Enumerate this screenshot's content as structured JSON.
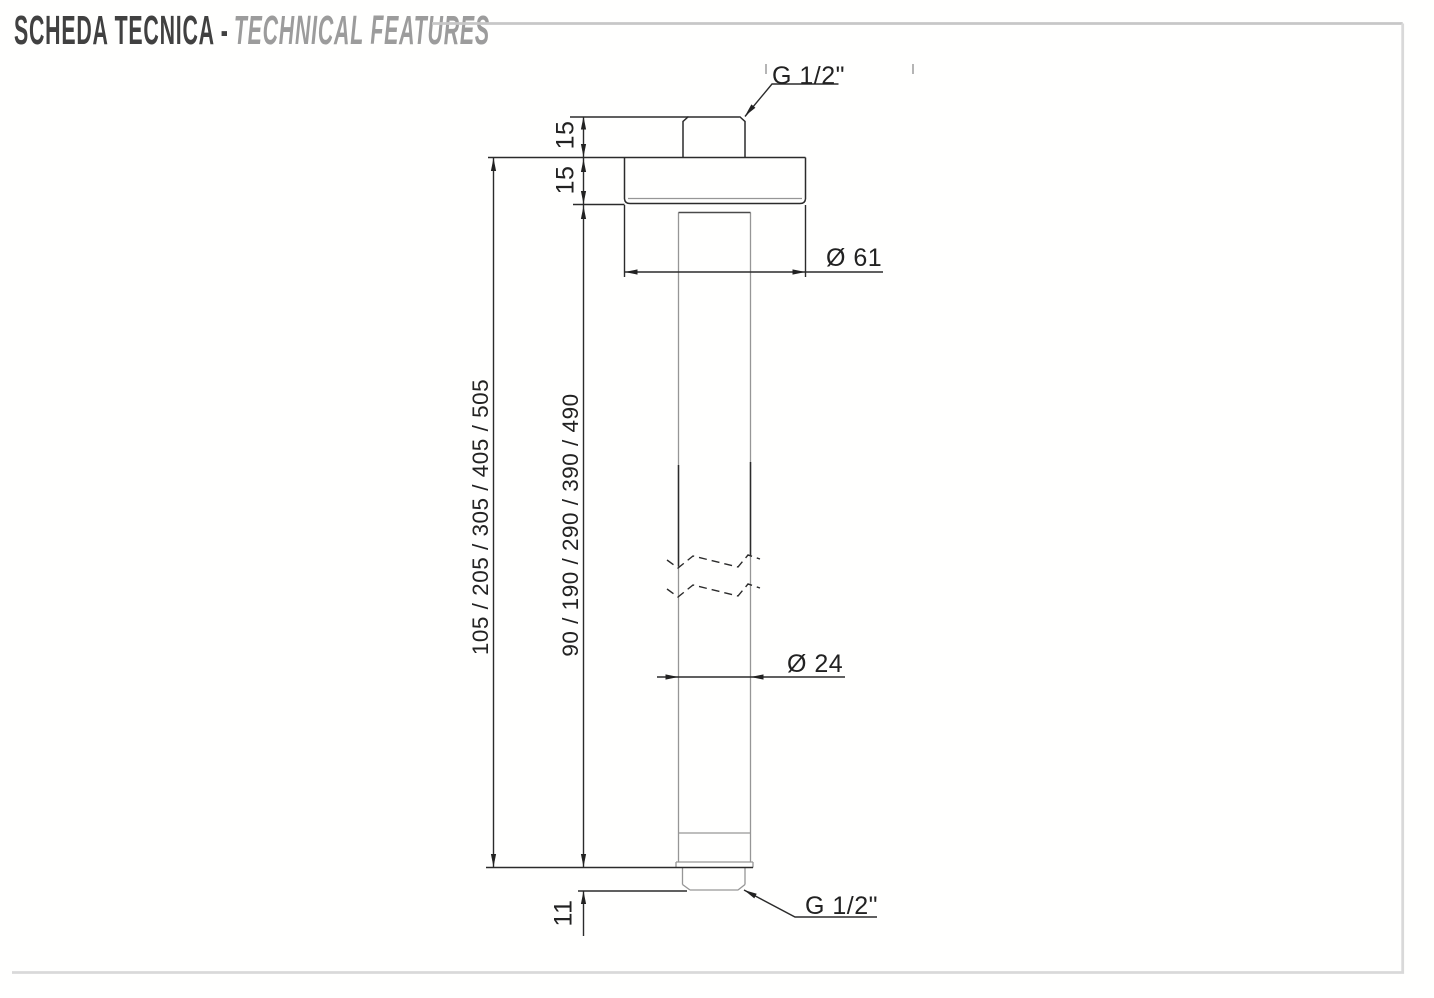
{
  "header": {
    "title_it": "SCHEDA TECNICA -",
    "title_en": "TECHNICAL FEATURES"
  },
  "dimensions": {
    "thread_top": "G 1/2\"",
    "thread_bottom": "G 1/2\"",
    "flange_diameter": "Ø 61",
    "pipe_diameter": "Ø 24",
    "nipple_height": "15",
    "flange_height": "15",
    "bottom_thread_length": "11",
    "total_lengths": "105 / 205 / 305 / 405 / 505",
    "arm_lengths": "90 / 190 / 290 / 390 / 490"
  },
  "colors": {
    "line_dark": "#2b2b2b",
    "line_gray": "#969696",
    "frame_gray": "#d9d9d9",
    "rule_gray": "#c7c7c7",
    "title_dark": "#414141",
    "title_gray": "#9c9c9c"
  }
}
